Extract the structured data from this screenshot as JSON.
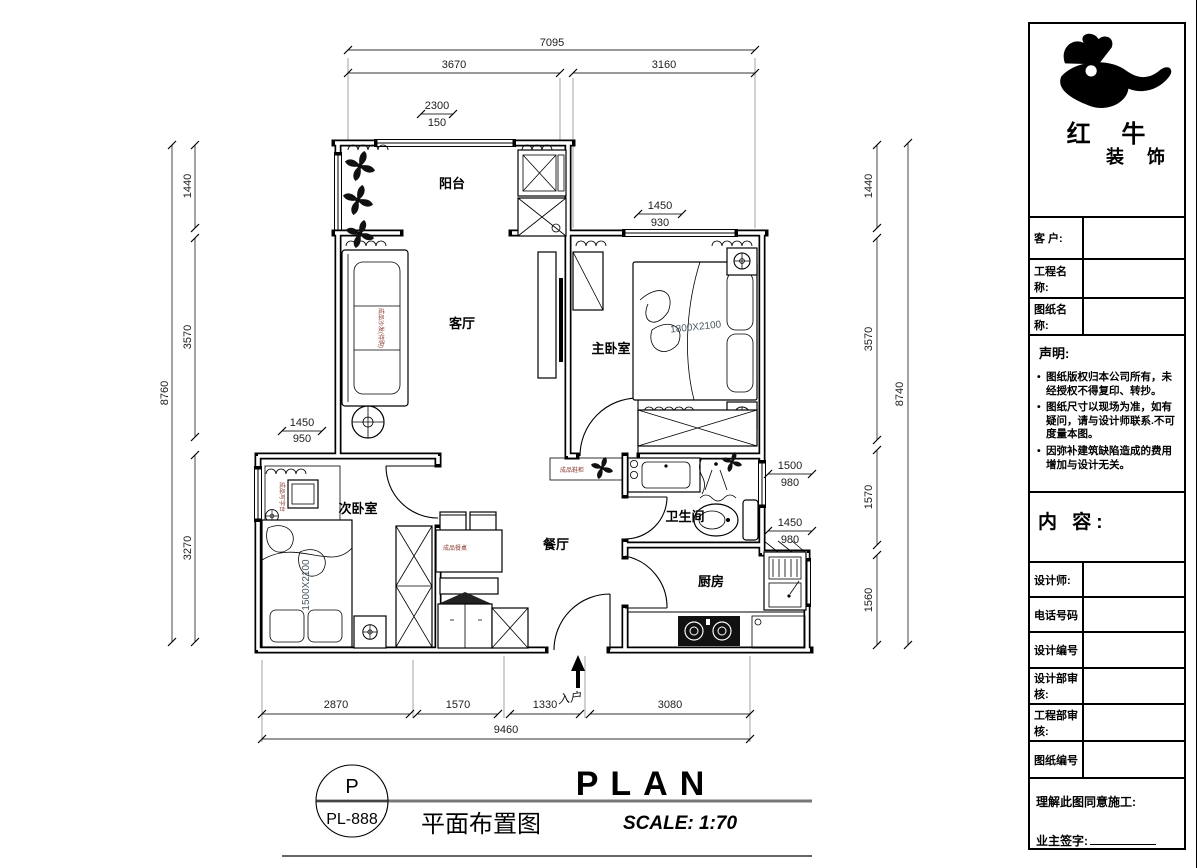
{
  "drawing": {
    "rooms": {
      "balcony": "阳台",
      "living": "客厅",
      "master": "主卧室",
      "second": "次卧室",
      "dining": "餐厅",
      "bath": "卫生间",
      "kitchen": "厨房"
    },
    "dims": {
      "top_overall": "7095",
      "top_left": "3670",
      "top_right": "3160",
      "balcony_win_num": "2300",
      "balcony_win_den": "150",
      "left_overall": "8760",
      "left_1": "1440",
      "left_2": "3570",
      "left_3": "3270",
      "second_win_num": "1450",
      "second_win_den": "950",
      "master_win_num": "1450",
      "master_win_den": "930",
      "right_overall": "8740",
      "right_1": "1440",
      "right_2": "3570",
      "right_3": "1570",
      "right_4": "1560",
      "bath_win_num": "1500",
      "bath_win_den": "980",
      "kitchen_win_num": "1450",
      "kitchen_win_den": "980",
      "bottom_1": "2870",
      "bottom_2": "1570",
      "bottom_3": "1330",
      "bottom_4": "3080",
      "bottom_overall": "9460"
    },
    "furniture": {
      "master_bed_size": "1800X2100",
      "second_bed_size": "1500X2100",
      "sofa_label": "成品沙发(待购)",
      "desk_label": "成品写字台",
      "dining_table_label": "成品餐桌",
      "shoe_cabinet_label": "成品鞋柜"
    },
    "entry_label": "入户"
  },
  "footer": {
    "badge_letter": "P",
    "badge_code": "PL-888",
    "title_cn": "平面布置图",
    "title_en": "PLAN",
    "scale_label": "SCALE: 1:70"
  },
  "title_block": {
    "brand": {
      "line1": "红 牛",
      "line2": "装 饰"
    },
    "fields": [
      {
        "label": "客  户:"
      },
      {
        "label": "工程名称:"
      },
      {
        "label": "图纸名称:"
      }
    ],
    "statement": {
      "heading": "声明:",
      "items": [
        "图纸版权归本公司所有，未经授权不得复印、转抄。",
        "图纸尺寸以现场为准，如有疑问，请与设计师联系.不可度量本图。",
        "因弥补建筑缺陷造成的费用增加与设计无关。"
      ]
    },
    "content_heading": "内 容:",
    "info_fields": [
      {
        "label": "设计师:"
      },
      {
        "label": "电话号码"
      },
      {
        "label": "设计编号"
      },
      {
        "label": "设计部审核:"
      },
      {
        "label": "工程部审核:"
      },
      {
        "label": "图纸编号"
      }
    ],
    "approval": {
      "line1": "理解此图同意施工:",
      "line2": "业主签字:"
    }
  }
}
